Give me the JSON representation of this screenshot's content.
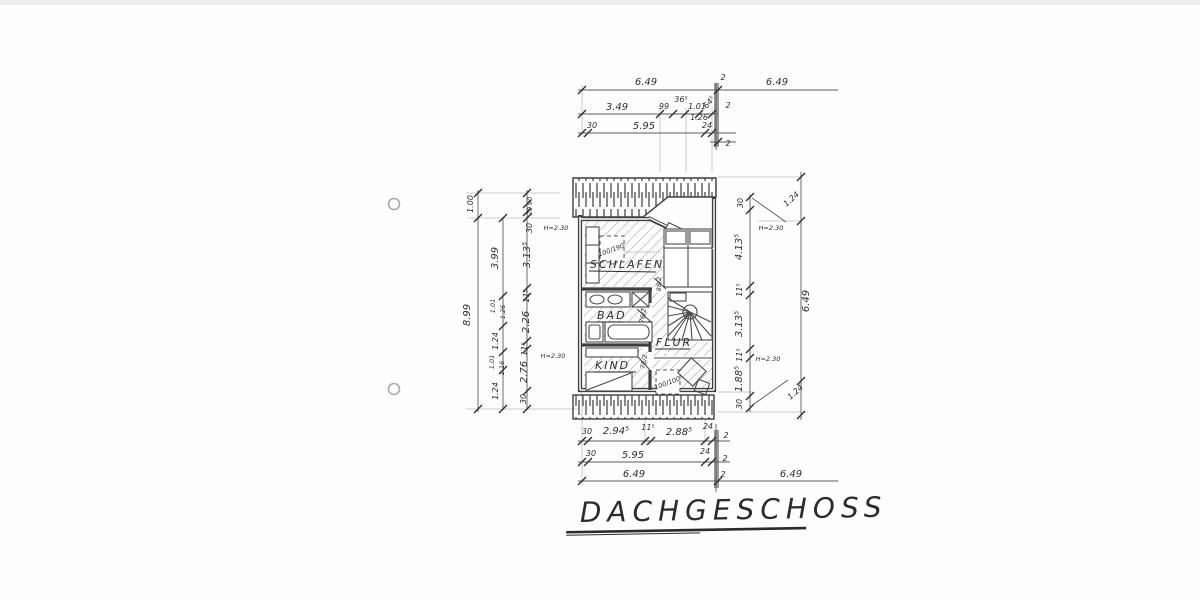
{
  "document": {
    "title": "DACHGESCHOSS"
  },
  "rooms": {
    "schlafen": "SCHLAFEN",
    "bad": "BAD",
    "flur": "FLUR",
    "kind": "KIND"
  },
  "annotations": {
    "h230_left_top": "H=2.30",
    "h230_left_bottom": "H=2.30",
    "h230_right_top": "H=2.30",
    "h230_right_bottom": "H=2.30",
    "box_schlafen": "100/190",
    "box_flur": "100/100",
    "door_schlafen": "88/2",
    "door_bad": "76/2",
    "door_kind": "76/2"
  },
  "dims_top": {
    "row1": [
      "6.49",
      "2",
      "6.49"
    ],
    "row2": [
      "3.49",
      "99",
      "36⁵",
      "1.01",
      "1.26",
      "64⁵",
      "2"
    ],
    "row3": [
      "30",
      "5.95",
      "24",
      "2"
    ]
  },
  "dims_bottom": {
    "row1": [
      "30",
      "2.94⁵",
      "11⁵",
      "2.88⁵",
      "24",
      "2"
    ],
    "row2": [
      "30",
      "5.95",
      "24",
      "2"
    ],
    "row3": [
      "6.49",
      "2",
      "6.49"
    ]
  },
  "dims_left": {
    "outer": [
      "1.00",
      "8.99"
    ],
    "mid": [
      "3.99",
      "1.01",
      "1.26",
      "1.24",
      "1.01",
      "1.16",
      "1.24"
    ],
    "inner": [
      "90",
      "20",
      "30",
      "3.13⁵",
      "11⁵",
      "2.26",
      "11⁵",
      "2.76",
      "30"
    ]
  },
  "dims_right": {
    "inner": [
      "30",
      "4.13⁵",
      "11⁵",
      "3.13⁵",
      "11⁵",
      "1.88⁵",
      "30"
    ],
    "outer": [
      "1.24",
      "6.49",
      "1.24"
    ]
  }
}
